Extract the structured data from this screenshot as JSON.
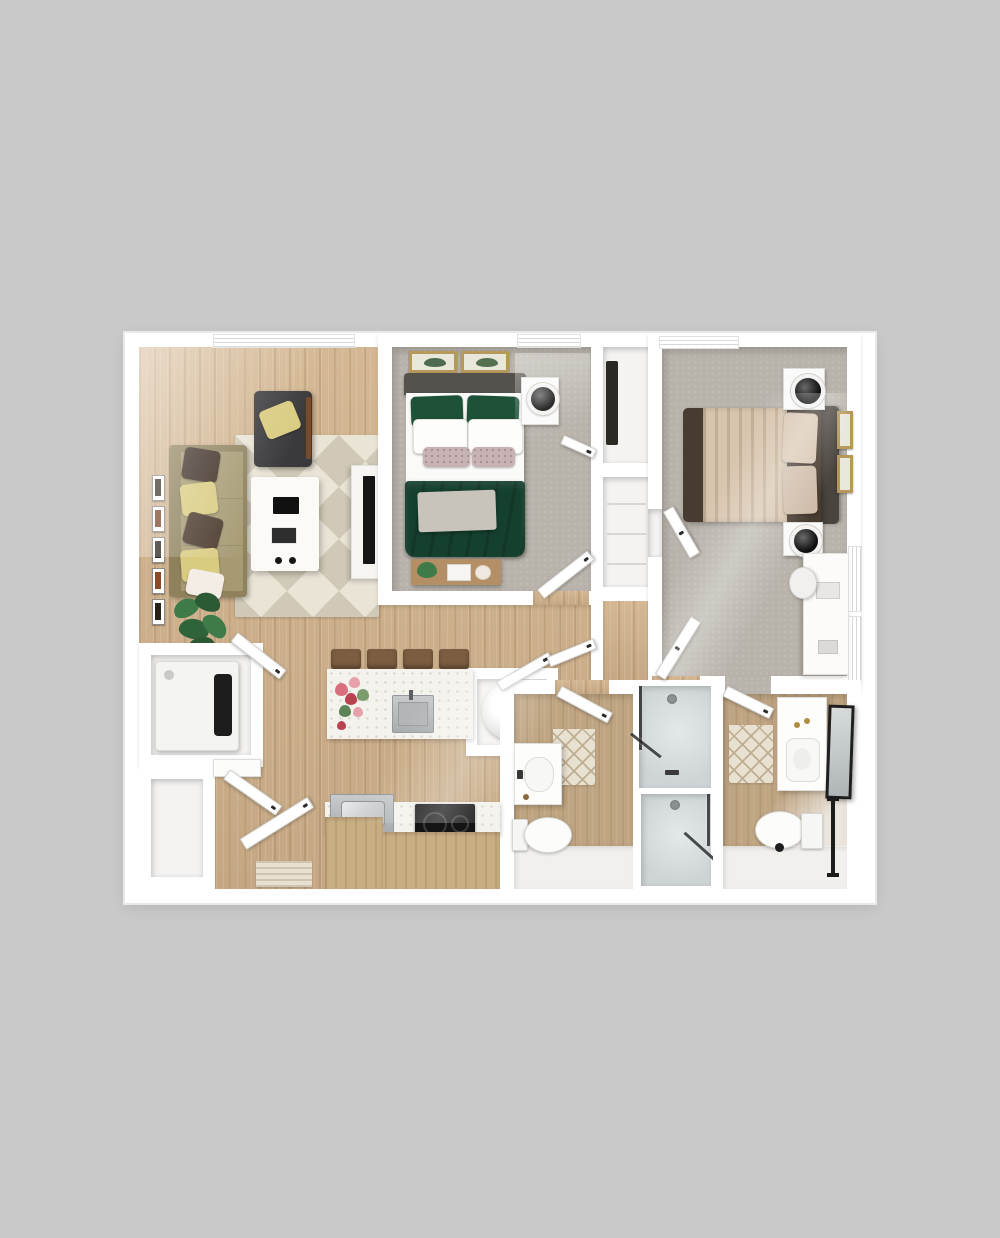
{
  "scene": {
    "kind": "3d-rendered-floor-plan",
    "description": "Top-down 3D apartment floor plan: two bedrooms, two bathrooms, open living room and kitchen, laundry closet and entry",
    "visible_text": "none"
  },
  "palette": {
    "bg": "#c9c9c9",
    "wall": "#ffffff",
    "wood": "#d1b28b",
    "tile": "#c8a87f",
    "carpet": "#b8b3ab",
    "rugBase": "#e9e4d6",
    "rugPattern": "#d0c9b7",
    "sofa": "#a69a73",
    "sofaTrim": "#8e815c",
    "pillowYellow": "#d9cb80",
    "pillowBrown": "#3b2d22",
    "pillowWhite": "#f3ede6",
    "greenPillow": "#1d5138",
    "greenDuvet": "#153f2f",
    "headboard": "#55524e",
    "throwGray": "#c9c4bb",
    "bed2Dark": "#483b31",
    "bed2Blanket": "#d8c5ae",
    "bed2Pillow": "#d9c6b2",
    "gold": "#b5985a",
    "stool": "#7c5d41",
    "cabinet": "#c9ad83",
    "steel": "#bcc0c2",
    "cooktop": "#141414",
    "showerFloor": "#ced4d6",
    "glass": "#2e2e2e",
    "matBase": "#e8e0d0",
    "matLine": "#bfae92",
    "plantGreen": "#3f7b49",
    "plantDark": "#2c5a35",
    "lamp": "#1b1b1b"
  },
  "rooms": [
    {
      "name": "living-room",
      "floor": "wood",
      "furniture": [
        "sofa",
        "throw-pillows",
        "geometric-rug",
        "coffee-table",
        "accent-armchair",
        "tv-console",
        "potted-plant",
        "gallery-wall-frames",
        "window"
      ]
    },
    {
      "name": "bedroom-1",
      "floor": "carpet",
      "furniture": [
        "queen-bed-green-bedding",
        "nightstand-with-lamp",
        "two-framed-pictures",
        "bench-with-decor",
        "window",
        "closet"
      ]
    },
    {
      "name": "bedroom-2",
      "floor": "carpet",
      "furniture": [
        "queen-bed-brown-bedding",
        "two-nightstands-with-lamps",
        "two-framed-pictures",
        "desk-with-chair",
        "windows"
      ]
    },
    {
      "name": "kitchen",
      "floor": "wood",
      "furniture": [
        "island-with-sink",
        "four-bar-stools",
        "flower-vase",
        "counter-run",
        "steel-appliance",
        "cooktop",
        "cabinets"
      ]
    },
    {
      "name": "bathroom-1",
      "floor": "wood-tile",
      "furniture": [
        "vanity-sink",
        "toilet",
        "bath-mat",
        "walk-in-shower"
      ]
    },
    {
      "name": "bathroom-2",
      "floor": "wood-tile",
      "furniture": [
        "vanity-sink",
        "leaning-mirror",
        "toilet",
        "bath-mat",
        "walk-in-shower",
        "towel-bar"
      ]
    },
    {
      "name": "laundry-closet",
      "floor": "white",
      "furniture": [
        "washer-dryer"
      ]
    },
    {
      "name": "water-heater-closet",
      "floor": "white",
      "furniture": [
        "water-heater-tank"
      ]
    },
    {
      "name": "entry",
      "floor": "wood",
      "furniture": [
        "front-door",
        "door-mat",
        "coat-closet",
        "console-shelf"
      ]
    }
  ]
}
